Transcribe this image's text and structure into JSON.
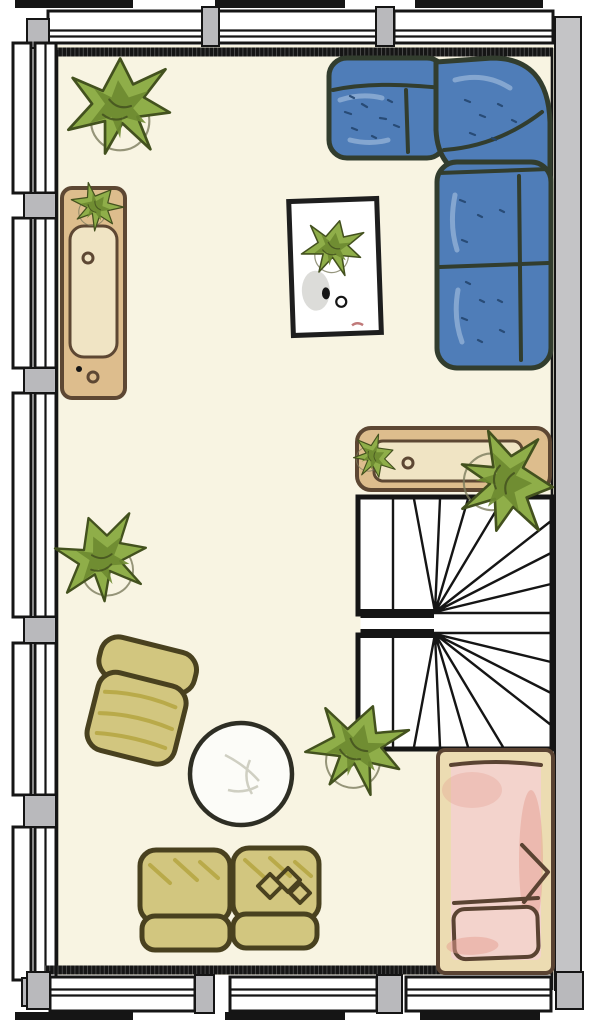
{
  "title": "apartment-floor-plan",
  "colors": {
    "floor": "#f8f4e2",
    "wall_black": "#151515",
    "pillar_gray": "#b9b9bc",
    "right_wall_gray": "#c4c4c6",
    "sofa_blue": "#4f7db8",
    "sofa_speck": "#23466f",
    "sofa_outline": "#323d2e",
    "wood": "#ddbd8d",
    "wood_light": "#f0e4c4",
    "wood_outline": "#5d4733",
    "olive": "#b3a23c",
    "olive_light": "#d2c67f",
    "olive_outline": "#49411f",
    "plant_green": "#8fae49",
    "plant_mid": "#6d8a30",
    "plant_dark": "#43511e",
    "bed_frame": "#ecdcb2",
    "bed_outline": "#5a4332",
    "bed_pink": "#f3d3cc",
    "bed_pink_deep": "#e6a092",
    "table_white": "#fcfcf8"
  },
  "room": {
    "window_segments_top": 3,
    "window_segments_bottom": 3,
    "window_segments_left": 5,
    "staircase": {
      "type": "double-winder",
      "flights": 2,
      "treads_per_flight": 10
    }
  },
  "furniture": [
    {
      "name": "corner-sofa",
      "color_key": "sofa_blue"
    },
    {
      "name": "tall-sideboard",
      "color_key": "wood"
    },
    {
      "name": "hall-sideboard",
      "color_key": "wood"
    },
    {
      "name": "picture-with-plant",
      "color_key": "table_white"
    },
    {
      "name": "armchair",
      "color_key": "olive_light"
    },
    {
      "name": "round-coffee-table",
      "color_key": "table_white"
    },
    {
      "name": "loveseat",
      "color_key": "olive_light"
    },
    {
      "name": "bed",
      "color_key": "bed_pink"
    },
    {
      "name": "potted-plant",
      "count": 6,
      "color_key": "plant_green"
    }
  ]
}
